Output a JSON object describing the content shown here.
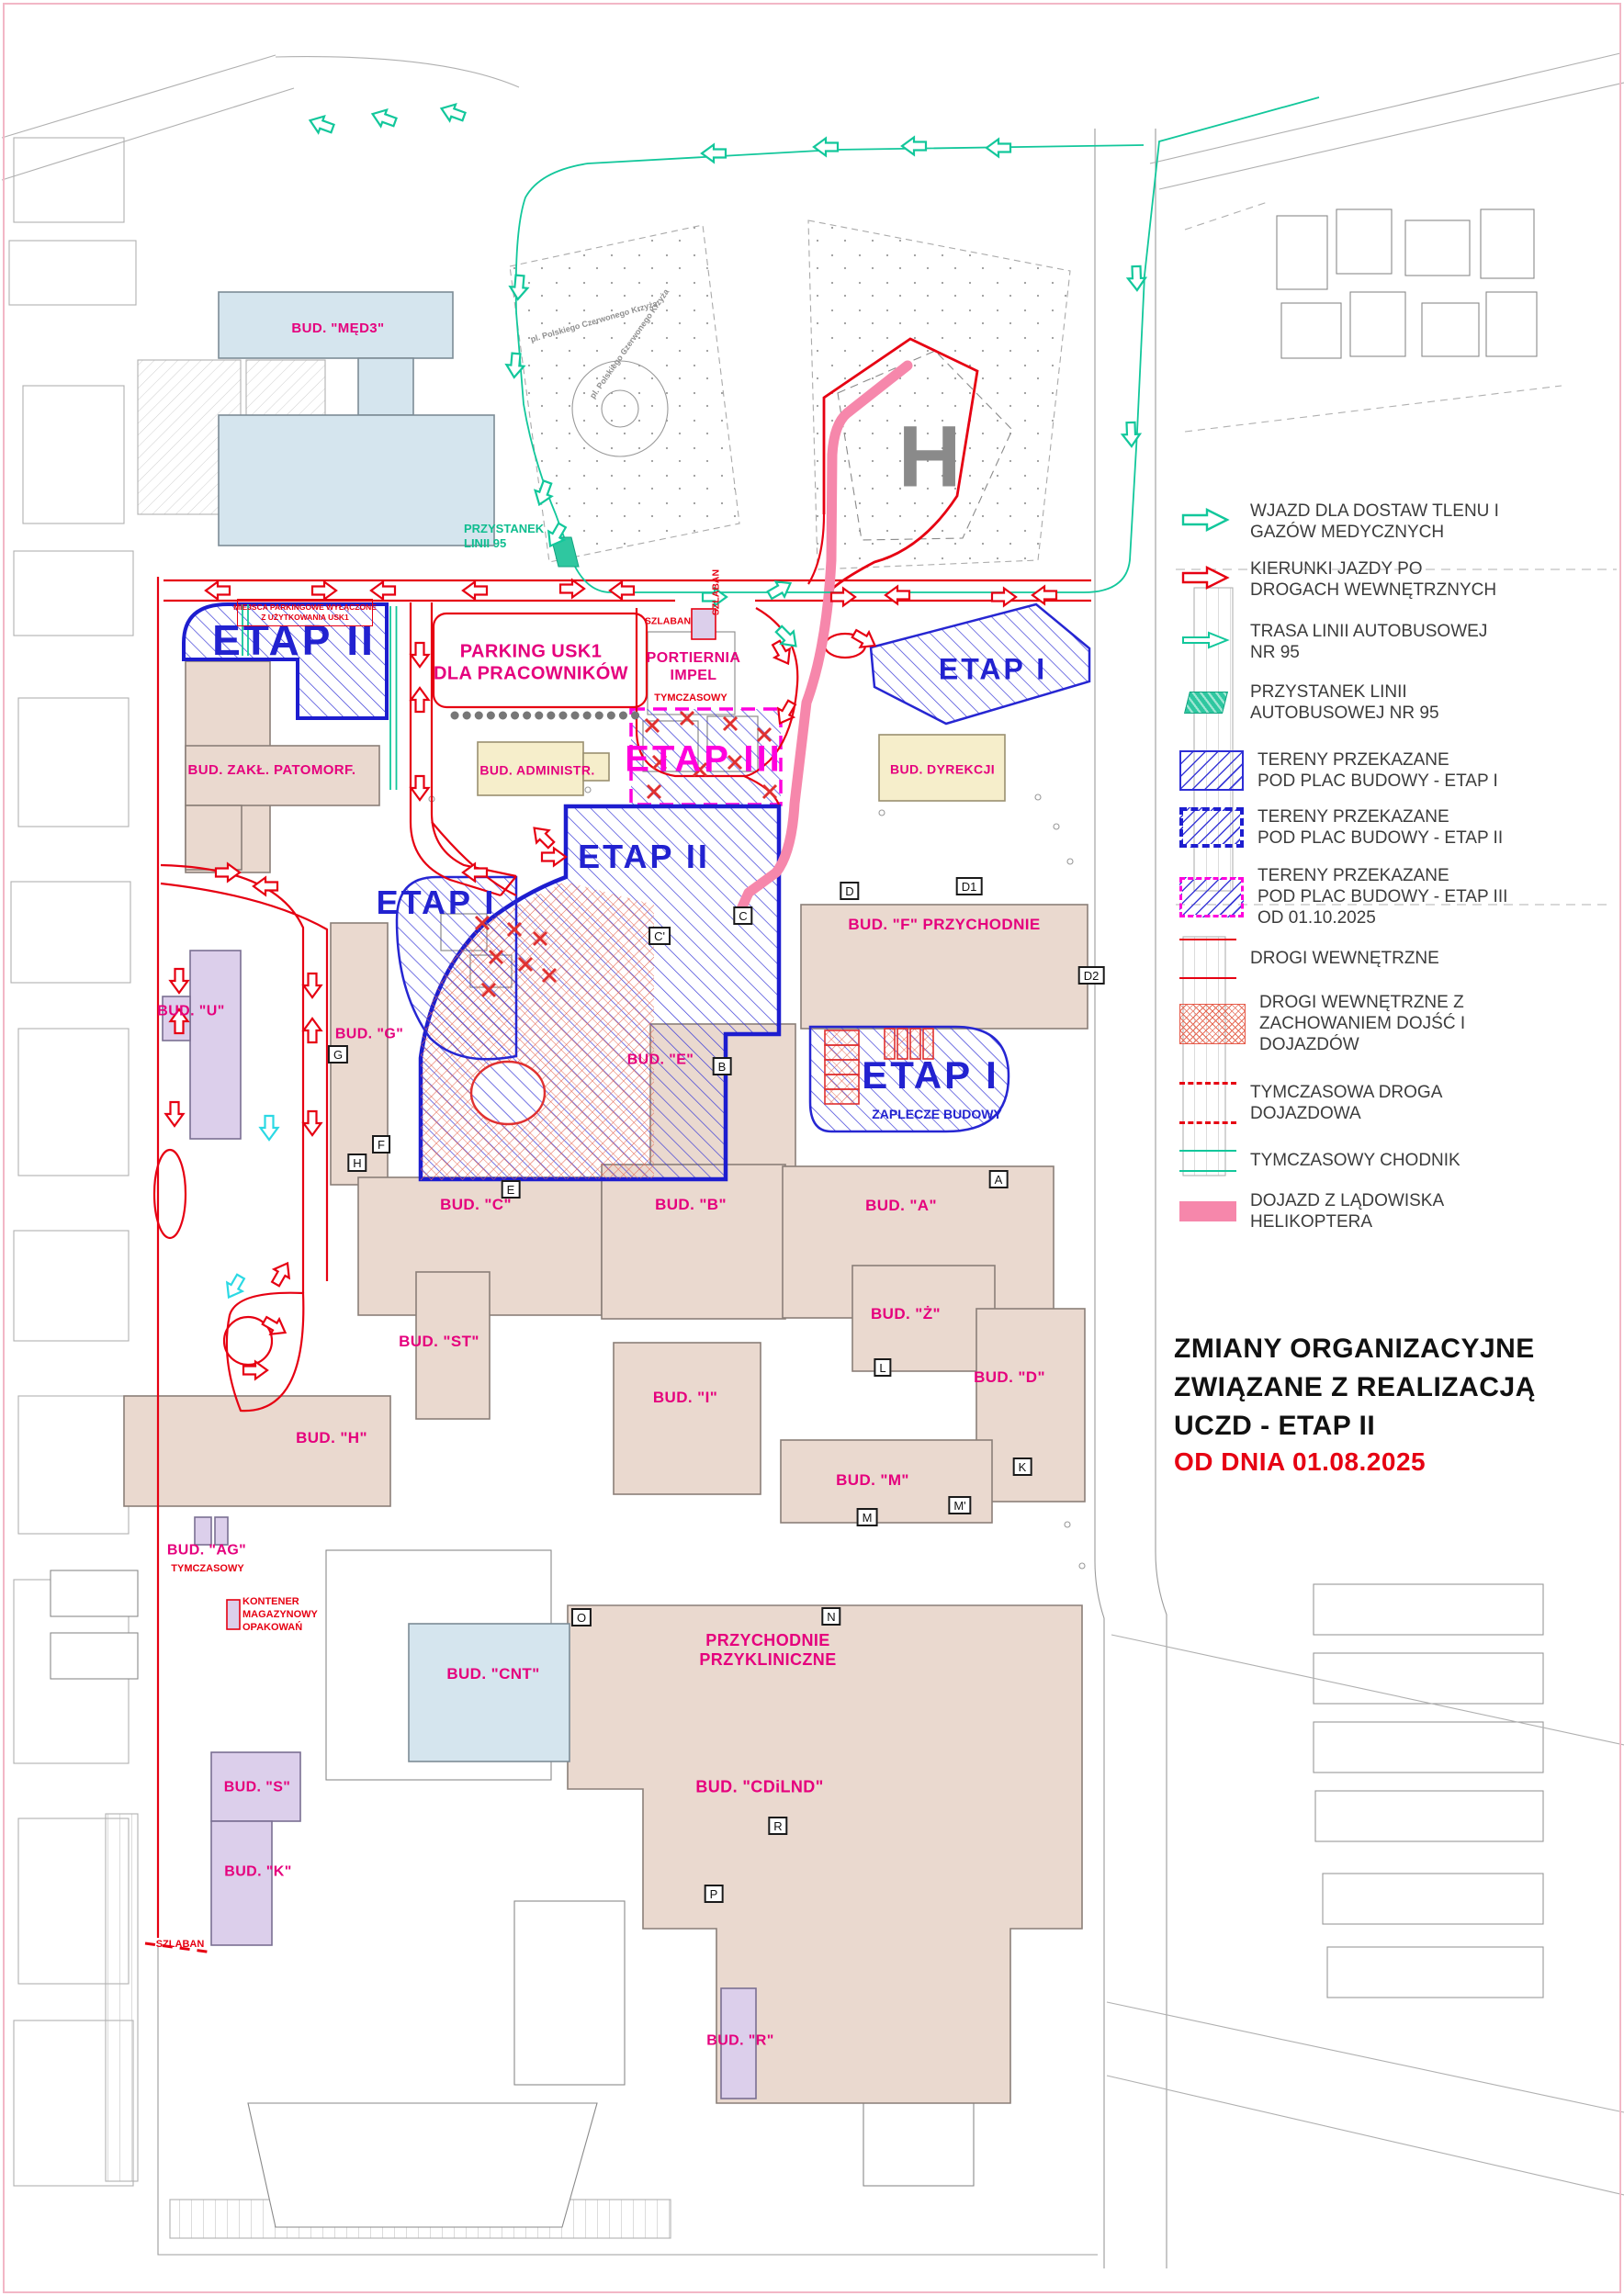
{
  "title": {
    "main": "ZMIANY ORGANIZACYJNE\nZWIĄZANE Z REALIZACJĄ\nUCZD - ETAP II",
    "date": "OD DNIA 01.08.2025"
  },
  "legend": {
    "items": [
      {
        "symbol": "teal-arrow",
        "label": "WJAZD DLA DOSTAW TLENU I\nGAZÓW MEDYCZNYCH"
      },
      {
        "symbol": "red-arrow",
        "label": "KIERUNKI JAZDY PO\nDROGACH WEWNĘTRZNYCH"
      },
      {
        "symbol": "teal-arrow-thin",
        "label": "TRASA LINII AUTOBUSOWEJ\nNR 95"
      },
      {
        "symbol": "bus-stop",
        "label": "PRZYSTANEK LINII\nAUTOBUSOWEJ NR 95"
      },
      {
        "symbol": "hatch-etap1",
        "label": "TERENY PRZEKAZANE\nPOD PLAC BUDOWY - ETAP I"
      },
      {
        "symbol": "hatch-etap2",
        "label": "TERENY PRZEKAZANE\nPOD PLAC BUDOWY - ETAP II"
      },
      {
        "symbol": "hatch-etap3",
        "label": "TERENY PRZEKAZANE\nPOD PLAC BUDOWY - ETAP III\nOD 01.10.2025"
      },
      {
        "symbol": "red-line",
        "label": "DROGI WEWNĘTRZNE"
      },
      {
        "symbol": "red-crosshatch",
        "label": "DROGI WEWNĘTRZNE Z\nZACHOWANIEM DOJŚĆ I\nDOJAZDÓW"
      },
      {
        "symbol": "red-dashed",
        "label": "TYMCZASOWA DROGA\nDOJAZDOWA"
      },
      {
        "symbol": "teal-line",
        "label": "TYMCZASOWY CHODNIK"
      },
      {
        "symbol": "pink-bar",
        "label": "DOJAZD Z LĄDOWISKA\nHELIKOPTERA"
      }
    ]
  },
  "map": {
    "zones": {
      "etap2_topleft": "ETAP II",
      "etap1_topright": "ETAP I",
      "etap3": "ETAP III",
      "etap2_center": "ETAP II",
      "etap1_left": "ETAP I",
      "etap1_right": "ETAP I"
    },
    "buildings": [
      "BUD. \"MĘD3\"",
      "BUD. ZAKŁ. PATOMORF.",
      "BUD. ADMINISTR.",
      "BUD. DYREKCJI",
      "BUD. \"F\" PRZYCHODNIE",
      "BUD. \"U\"",
      "BUD. \"G\"",
      "BUD. \"E\"",
      "BUD. \"C\"",
      "BUD. \"B\"",
      "BUD. \"A\"",
      "BUD. \"ST\"",
      "BUD. \"I\"",
      "BUD. \"Ż\"",
      "BUD. \"D\"",
      "BUD. \"M\"",
      "BUD. \"H\"",
      "BUD. \"AG\"",
      "BUD. \"CNT\"",
      "PRZYCHODNIE\nPRZYKLINICZNE",
      "BUD. \"CDiLND\"",
      "BUD. \"S\"",
      "BUD. \"K\"",
      "BUD. \"R\""
    ],
    "markers": [
      "A",
      "B",
      "C",
      "C'",
      "D",
      "D1",
      "D2",
      "E",
      "F",
      "G",
      "H",
      "K",
      "L",
      "M",
      "M'",
      "N",
      "O",
      "P",
      "R"
    ],
    "annotations": {
      "parking": "PARKING USK1\nDLA PRACOWNIKÓW",
      "portiernia": "PORTIERNIA\nIMPEL",
      "tymczasowy_portiernia": "TYMCZASOWY",
      "szlaban_gate": "SZLABAN",
      "szlaban_gate_v": "SZLABAN",
      "miejsca": "MIEJSCA PARKINGOWE WYŁĄCZONE\nZ UŻYTKOWANIA USK1",
      "przystanek": "PRZYSTANEK\nLINII 95",
      "zaplecze": "ZAPLECZE BUDOWY",
      "kontener": "KONTENER\nMAGAZYNOWY\nOPAKOWAŃ",
      "tymczasowy_ag": "TYMCZASOWY",
      "szlaban_bottom": "SZLABAN",
      "street": "pl. Polskiego Czerwonego Krzyża",
      "helipad": "H"
    },
    "colors": {
      "etap_blue": "#2222d0",
      "etap3_magenta": "#ff00dd",
      "road_red": "#e60012",
      "route_teal": "#12c79b",
      "heli_pink": "#f687ab",
      "label_pink": "#e5007d",
      "building_tan": "#ead9cf",
      "building_blue": "#d5e5ee",
      "building_cream": "#f6eecb",
      "building_purple": "#dccfeb"
    }
  }
}
